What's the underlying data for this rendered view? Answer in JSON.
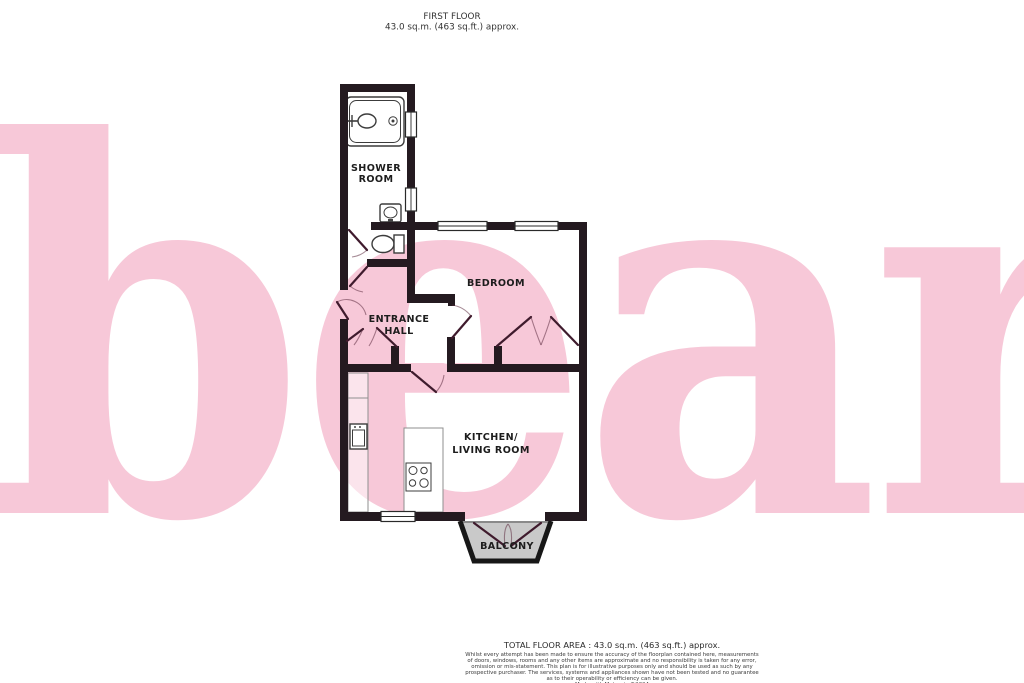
{
  "header": {
    "title": "FIRST FLOOR",
    "subtitle": "43.0 sq.m. (463 sq.ft.) approx."
  },
  "watermark": {
    "text": "bear"
  },
  "colors": {
    "wall": "#241a20",
    "door": "#3f1b2d",
    "watermark": "#f7c8d8",
    "balcony_fill": "#c9c9c9"
  },
  "rooms": {
    "shower_room": {
      "lines": [
        "SHOWER",
        "ROOM"
      ]
    },
    "bedroom": {
      "lines": [
        "BEDROOM"
      ]
    },
    "entrance_hall": {
      "lines": [
        "ENTRANCE",
        "HALL"
      ]
    },
    "kitchen_living": {
      "lines": [
        "KITCHEN/",
        "LIVING ROOM"
      ]
    },
    "balcony": {
      "lines": [
        "BALCONY"
      ]
    }
  },
  "footer": {
    "total_area": "TOTAL FLOOR AREA : 43.0 sq.m. (463 sq.ft.) approx.",
    "disclaimer": [
      "Whilst every attempt has been made to ensure the accuracy of the floorplan contained here, measurements",
      "of doors, windows, rooms and any other items are approximate and no responsibility is taken for any error,",
      "omission or mis-statement. This plan is for illustrative purposes only and should be used as such by any",
      "prospective purchaser. The services, systems and appliances shown have not been tested and no guarantee",
      "as to their operability or efficiency can be given.",
      "Made with Metropix ©2024"
    ]
  }
}
